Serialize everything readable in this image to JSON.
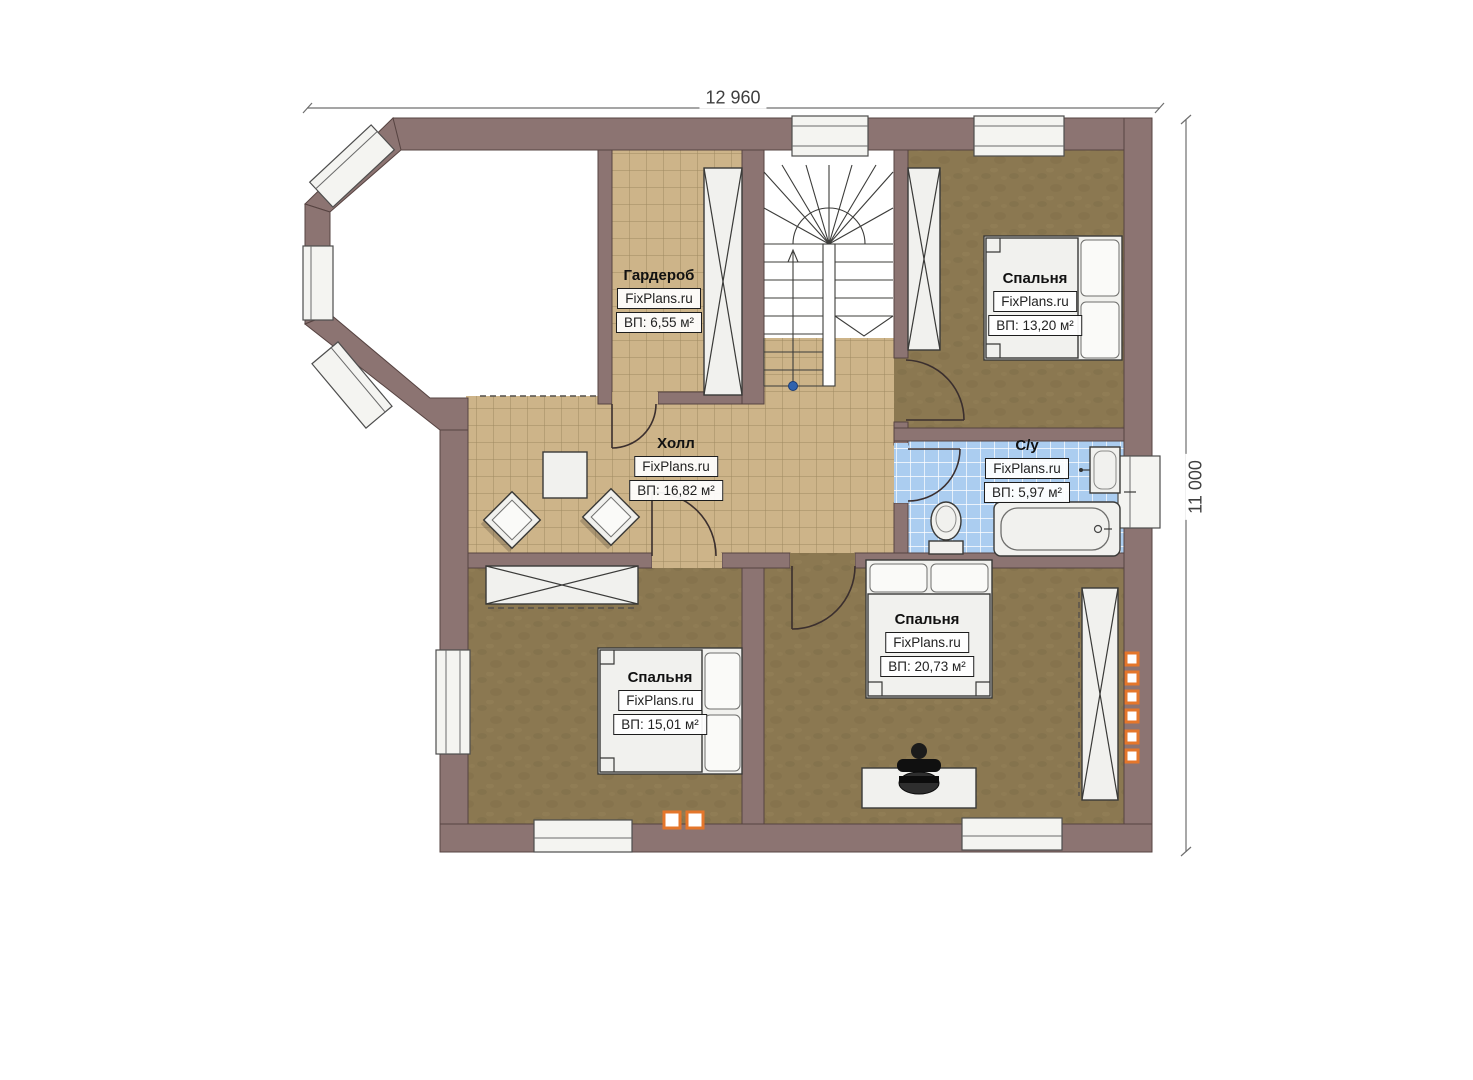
{
  "plan": {
    "dimensions": {
      "width_label": "12 960",
      "height_label": "11 000"
    },
    "rooms": [
      {
        "name": "Гардероб",
        "brand": "FixPlans.ru",
        "area": "ВП: 6,55 м²"
      },
      {
        "name": "Спальня",
        "brand": "FixPlans.ru",
        "area": "ВП: 13,20 м²"
      },
      {
        "name": "Холл",
        "brand": "FixPlans.ru",
        "area": "ВП: 16,82 м²"
      },
      {
        "name": "С/у",
        "brand": "FixPlans.ru",
        "area": "ВП: 5,97 м²"
      },
      {
        "name": "Спальня",
        "brand": "FixPlans.ru",
        "area": "ВП: 15,01 м²"
      },
      {
        "name": "Спальня",
        "brand": "FixPlans.ru",
        "area": "ВП: 20,73 м²"
      }
    ],
    "colors": {
      "wall": "#8c7472",
      "tan": "#cdb489",
      "brown": "#8b7851",
      "blue": "#abcdf0",
      "orange": "#e4762b",
      "dot": "#2f62ae"
    }
  }
}
